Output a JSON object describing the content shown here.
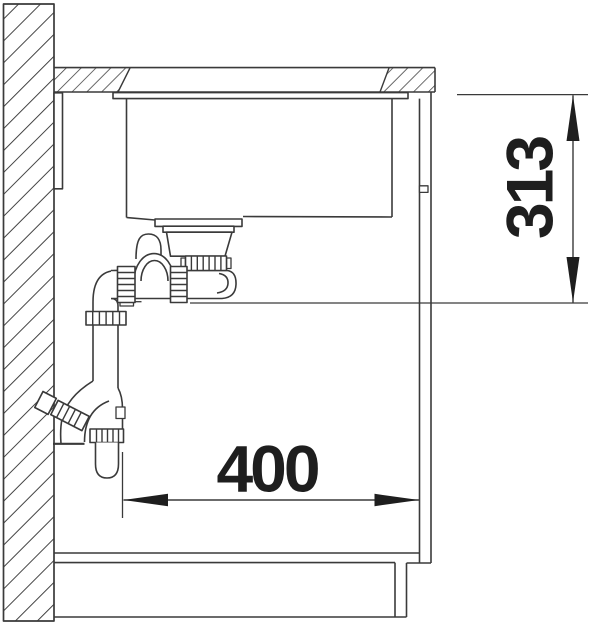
{
  "drawing": {
    "title": "sink-installation-section",
    "dimensions": {
      "vertical": "313",
      "horizontal": "400"
    },
    "colors": {
      "line": "#3a3a3a",
      "text": "#1e1e1e",
      "background": "#ffffff"
    }
  }
}
